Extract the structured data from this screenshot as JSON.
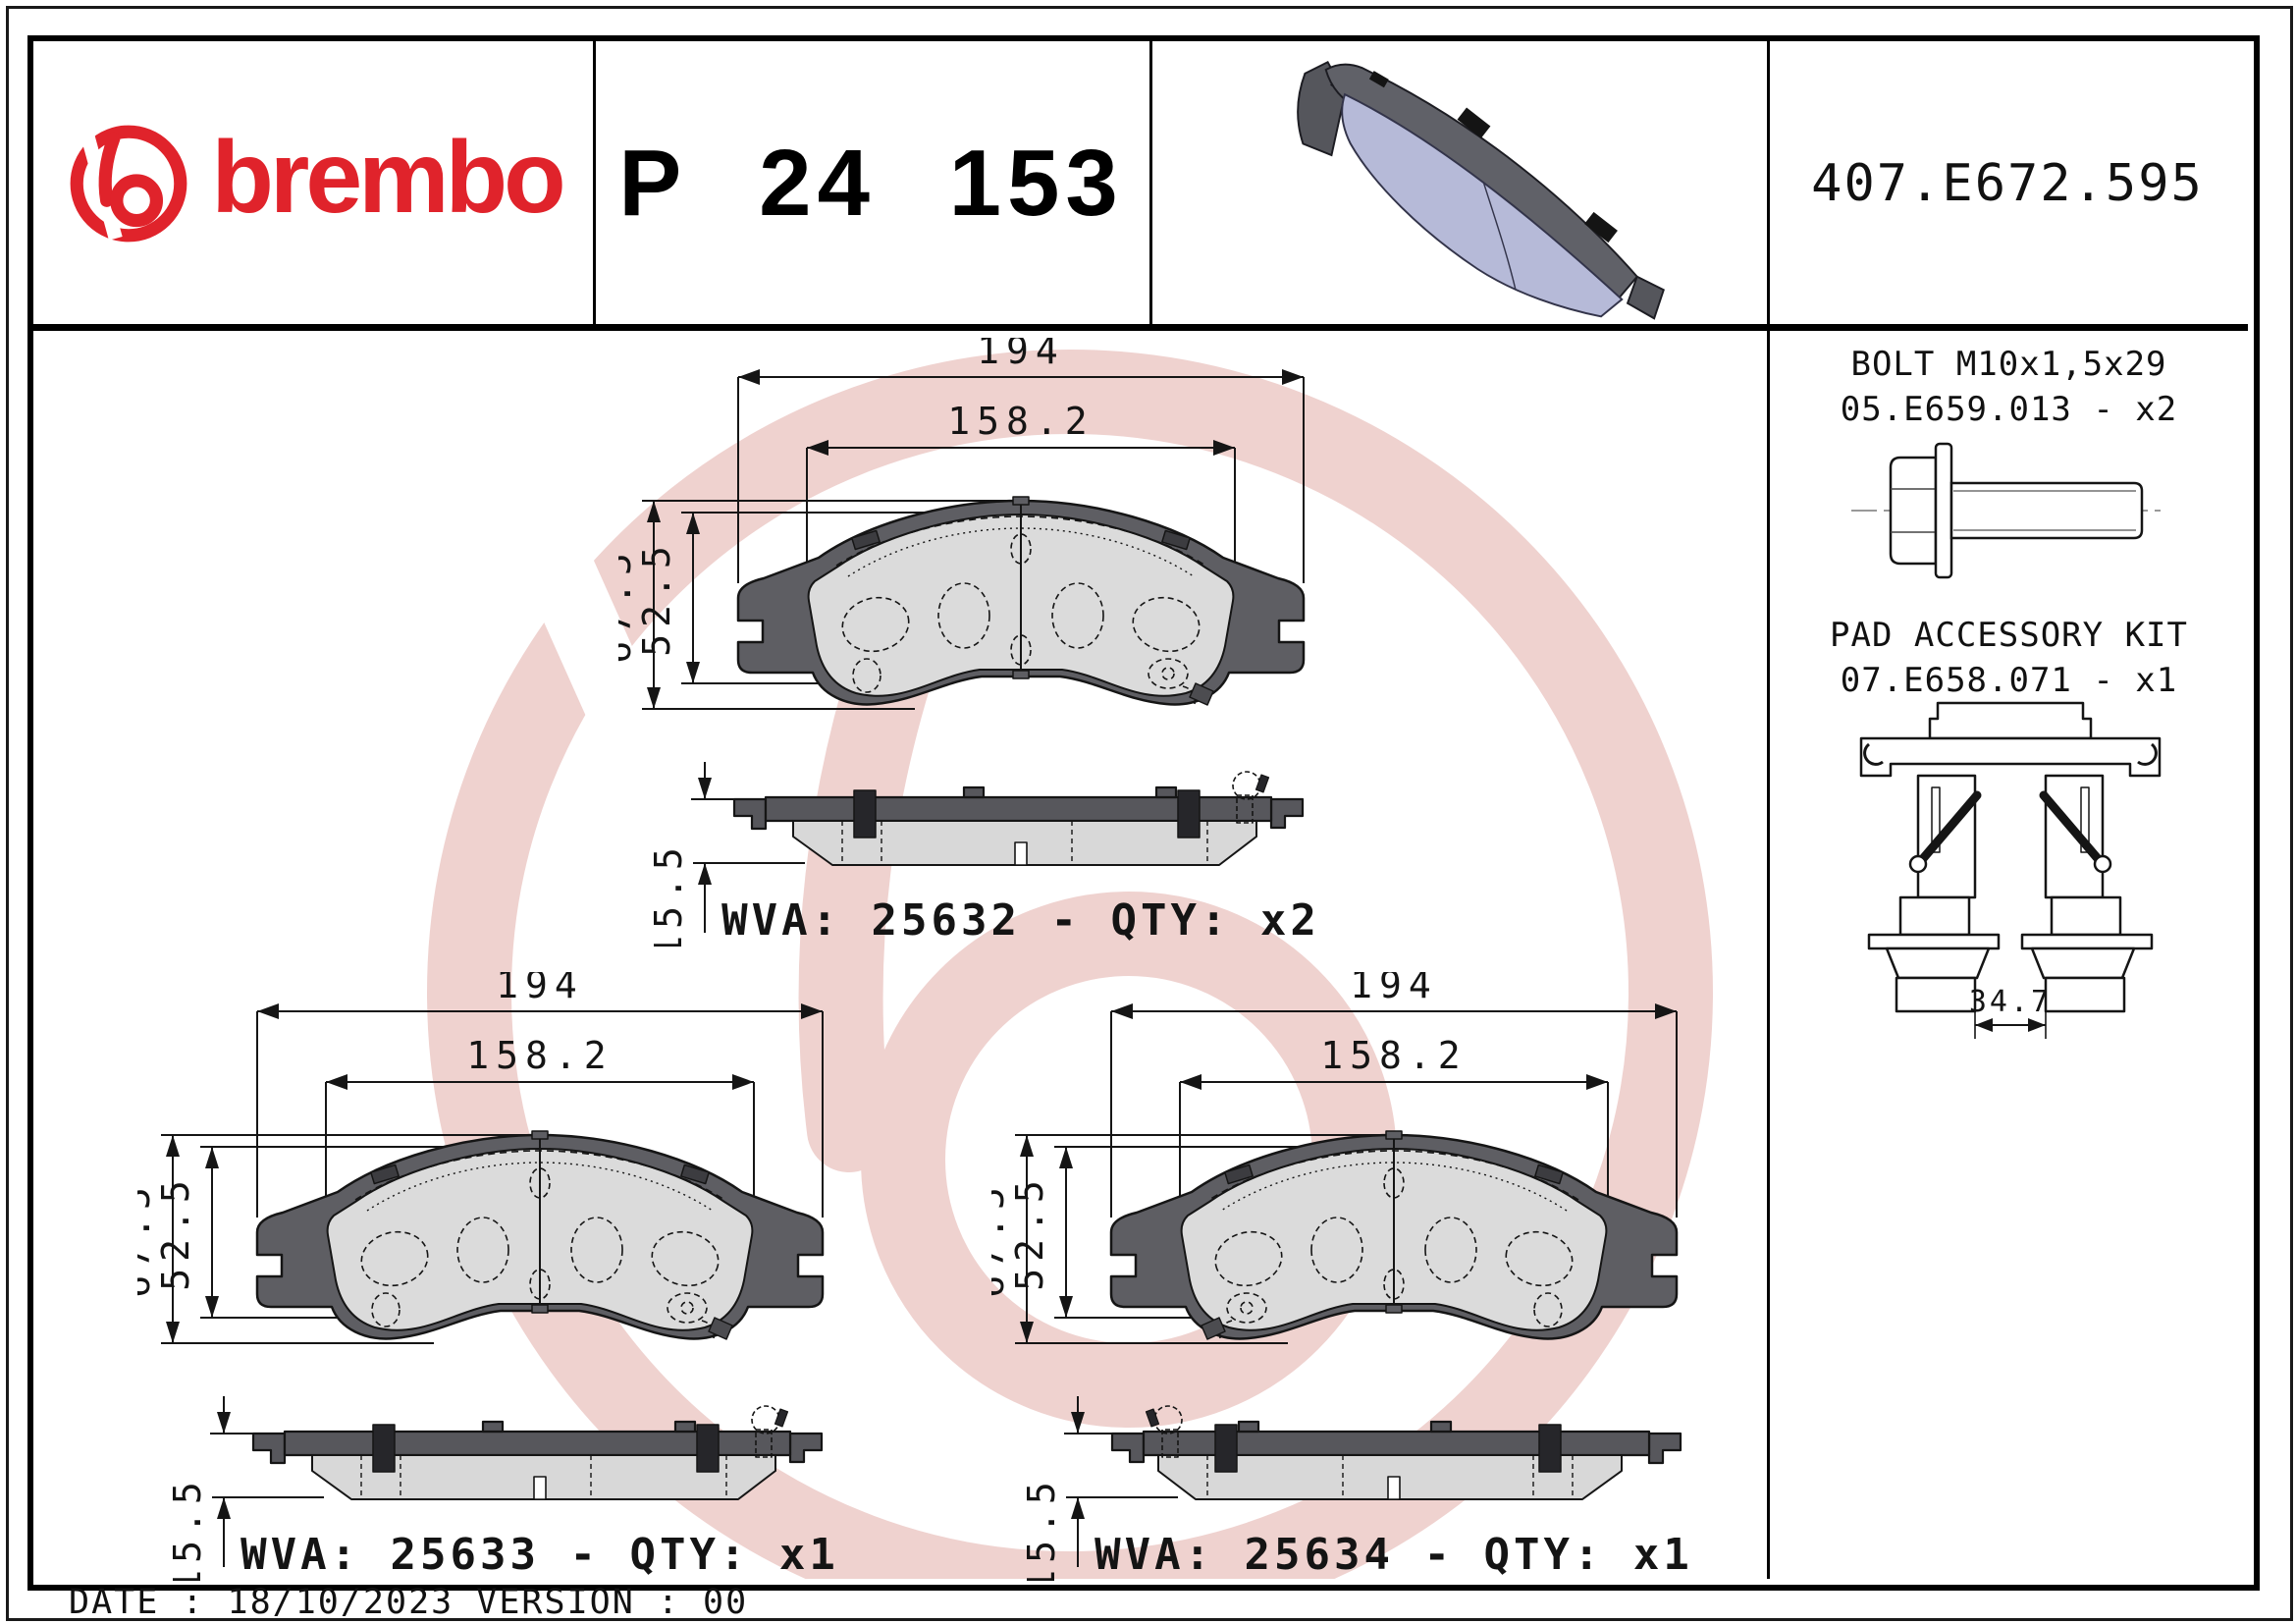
{
  "header": {
    "brand_wordmark": "brembo",
    "part_number": "P 24 153",
    "reference_code": "407.E672.595"
  },
  "sidebar": {
    "bolt": {
      "title": "BOLT M10x1,5x29",
      "code_qty": "05.E659.013 - x2"
    },
    "pad_accessory_kit": {
      "title": "PAD ACCESSORY KIT",
      "code_qty": "07.E658.071 - x1",
      "width_dim": "34.7"
    }
  },
  "drawings": {
    "blocks": [
      {
        "wva": "WVA: 25632 - QTY: x2",
        "dims": {
          "overall_width": "194",
          "pad_width": "158.2",
          "overall_height": "67.5",
          "pad_height": "52.5",
          "thickness": "15.5"
        }
      },
      {
        "wva": "WVA: 25633 - QTY: x1",
        "dims": {
          "overall_width": "194",
          "pad_width": "158.2",
          "overall_height": "67.5",
          "pad_height": "52.5",
          "thickness": "15.5"
        }
      },
      {
        "wva": "WVA: 25634 - QTY: x1",
        "dims": {
          "overall_width": "194",
          "pad_width": "158.2",
          "overall_height": "67.5",
          "pad_height": "52.5",
          "thickness": "15.5"
        }
      }
    ]
  },
  "footer": {
    "date_version": "DATE : 18/10/2023 VERSION : 00"
  },
  "colors": {
    "brand_red": "#e0232b",
    "watermark_pink": "#e2aca8",
    "plate_gray": "#5e5e63",
    "friction_gray": "#dbdbdb",
    "pad_lavender": "#b6bad8"
  }
}
